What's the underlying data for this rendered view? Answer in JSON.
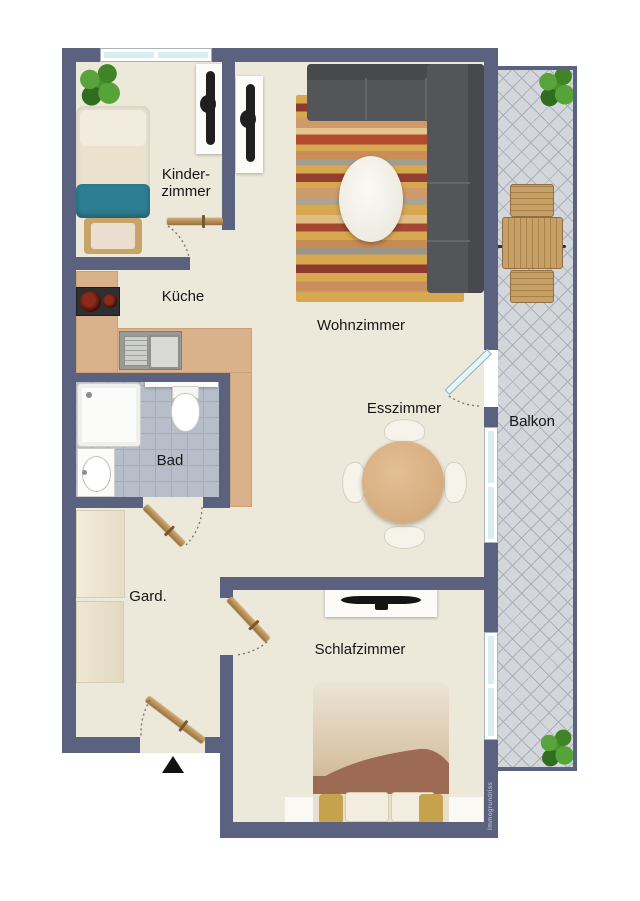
{
  "plan": {
    "labels": {
      "kinderzimmer_line1": "Kinder-",
      "kinderzimmer_line2": "zimmer",
      "kueche": "Küche",
      "wohnzimmer": "Wohnzimmer",
      "esszimmer": "Esszimmer",
      "balkon": "Balkon",
      "bad": "Bad",
      "garderobe": "Gard.",
      "schlafzimmer": "Schlafzimmer"
    },
    "watermark": "Immogrundriss",
    "colors": {
      "wall": "#5b6280",
      "floor": "#ece8da",
      "kitchen_counter": "#d9b28c",
      "bath_tile": "#b7bdc9",
      "balcony_tile": "#d3d7db",
      "child_bed_blanket_teal": "#2e7e93",
      "double_bed_blanket_brown": "#9d6a53",
      "sofa_gray": "#545559",
      "rug_gold": "#d8a850",
      "wood": "#c6a066",
      "door_wood": "#b98f55",
      "plant_green": "#4a9230",
      "window_glass": "#d8eef3"
    }
  }
}
